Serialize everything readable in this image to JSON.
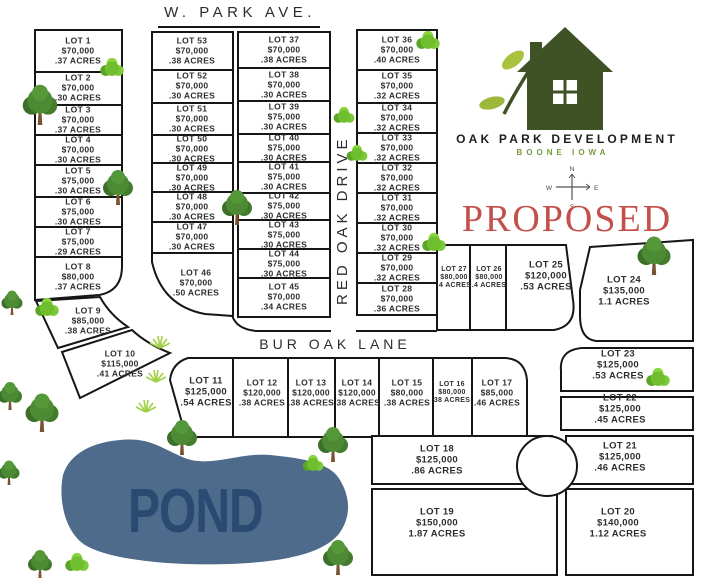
{
  "title": "Oak Park Development Plat Map",
  "streets": {
    "top": "W. PARK AVE.",
    "vertical": "RED OAK DRIVE",
    "horizontal": "BUR OAK LANE"
  },
  "branding": {
    "name": "OAK PARK DEVELOPMENT",
    "location": "BOONE   IOWA",
    "status": "PROPOSED"
  },
  "compass": {
    "n": "N",
    "e": "E",
    "s": "S",
    "w": "W"
  },
  "pond": {
    "label": "POND"
  },
  "colors": {
    "line": "#161616",
    "logo_green": "#3f5226",
    "leaf_green": "#a9c33f",
    "location_green": "#7a9a3d",
    "proposed_red": "#c3504b",
    "pond_fill": "#4e6b8c",
    "pond_text": "#2a4a72"
  },
  "lots": {
    "l1": {
      "name": "LOT 1",
      "price": "$70,000",
      "acres": ".37 ACRES"
    },
    "l2": {
      "name": "LOT 2",
      "price": "$70,000",
      "acres": ".30 ACRES"
    },
    "l3": {
      "name": "LOT 3",
      "price": "$70,000",
      "acres": ".37 ACRES"
    },
    "l4": {
      "name": "LOT 4",
      "price": "$70,000",
      "acres": ".30 ACRES"
    },
    "l5": {
      "name": "LOT 5",
      "price": "$75,000",
      "acres": ".30 ACRES"
    },
    "l6": {
      "name": "LOT 6",
      "price": "$75,000",
      "acres": ".30 ACRES"
    },
    "l7": {
      "name": "LOT 7",
      "price": "$75,000",
      "acres": ".29 ACRES"
    },
    "l8": {
      "name": "LOT 8",
      "price": "$80,000",
      "acres": ".37 ACRES"
    },
    "l9": {
      "name": "LOT 9",
      "price": "$85,000",
      "acres": ".38 ACRES"
    },
    "l10": {
      "name": "LOT 10",
      "price": "$115,000",
      "acres": ".41 ACRES"
    },
    "l11": {
      "name": "LOT 11",
      "price": "$125,000",
      "acres": ".54 ACRES"
    },
    "l12": {
      "name": "LOT 12",
      "price": "$120,000",
      "acres": ".38 ACRES"
    },
    "l13": {
      "name": "LOT 13",
      "price": "$120,000",
      "acres": ".38 ACRES"
    },
    "l14": {
      "name": "LOT 14",
      "price": "$120,000",
      "acres": ".38 ACRES"
    },
    "l15": {
      "name": "LOT 15",
      "price": "$80,000",
      "acres": ".38 ACRES"
    },
    "l16": {
      "name": "LOT 16",
      "price": "$80,000",
      "acres": "38 ACRES"
    },
    "l17": {
      "name": "LOT 17",
      "price": "$85,000",
      "acres": ".46 ACRES"
    },
    "l18": {
      "name": "LOT 18",
      "price": "$125,000",
      "acres": ".86 ACRES"
    },
    "l19": {
      "name": "LOT 19",
      "price": "$150,000",
      "acres": "1.87 ACRES"
    },
    "l20": {
      "name": "LOT 20",
      "price": "$140,000",
      "acres": "1.12 ACRES"
    },
    "l21": {
      "name": "LOT 21",
      "price": "$125,000",
      "acres": ".46 ACRES"
    },
    "l22": {
      "name": "LOT 22",
      "price": "$125,000",
      "acres": ".45 ACRES"
    },
    "l23": {
      "name": "LOT 23",
      "price": "$125,000",
      "acres": ".53 ACRES"
    },
    "l24": {
      "name": "LOT 24",
      "price": "$135,000",
      "acres": "1.1 ACRES"
    },
    "l25": {
      "name": "LOT 25",
      "price": "$120,000",
      "acres": ".53 ACRES"
    },
    "l26": {
      "name": "LOT 26",
      "price": "$80,000",
      "acres": ".4 ACRES"
    },
    "l27": {
      "name": "LOT 27",
      "price": "$80,000",
      "acres": ".4 ACRES"
    },
    "l28": {
      "name": "LOT 28",
      "price": "$70,000",
      "acres": ".36 ACRES"
    },
    "l29": {
      "name": "LOT 29",
      "price": "$70,000",
      "acres": ".32 ACRES"
    },
    "l30": {
      "name": "LOT 30",
      "price": "$70,000",
      "acres": ".32 ACRES"
    },
    "l31": {
      "name": "LOT 31",
      "price": "$70,000",
      "acres": ".32 ACRES"
    },
    "l32": {
      "name": "LOT 32",
      "price": "$70,000",
      "acres": ".32 ACRES"
    },
    "l33": {
      "name": "LOT 33",
      "price": "$70,000",
      "acres": ".32 ACRES"
    },
    "l34": {
      "name": "LOT 34",
      "price": "$70,000",
      "acres": ".32 ACRES"
    },
    "l35": {
      "name": "LOT 35",
      "price": "$70,000",
      "acres": ".32 ACRES"
    },
    "l36": {
      "name": "LOT 36",
      "price": "$70,000",
      "acres": ".40 ACRES"
    },
    "l37": {
      "name": "LOT 37",
      "price": "$70,000",
      "acres": ".38 ACRES"
    },
    "l38": {
      "name": "LOT 38",
      "price": "$70,000",
      "acres": ".30 ACRES"
    },
    "l39": {
      "name": "LOT 39",
      "price": "$75,000",
      "acres": ".30 ACRES"
    },
    "l40": {
      "name": "LOT 40",
      "price": "$75,000",
      "acres": ".30 ACRES"
    },
    "l41": {
      "name": "LOT 41",
      "price": "$75,000",
      "acres": ".30 ACRES"
    },
    "l42": {
      "name": "LOT 42",
      "price": "$75,000",
      "acres": ".30 ACRES"
    },
    "l43": {
      "name": "LOT 43",
      "price": "$75,000",
      "acres": ".30 ACRES"
    },
    "l44": {
      "name": "LOT 44",
      "price": "$75,000",
      "acres": ".30 ACRES"
    },
    "l45": {
      "name": "LOT 45",
      "price": "$70,000",
      "acres": ".34 ACRES"
    },
    "l46": {
      "name": "LOT 46",
      "price": "$70,000",
      "acres": ".50 ACRES"
    },
    "l47": {
      "name": "LOT 47",
      "price": "$70,000",
      "acres": ".30 ACRES"
    },
    "l48": {
      "name": "LOT 48",
      "price": "$70,000",
      "acres": ".30 ACRES"
    },
    "l49": {
      "name": "LOT 49",
      "price": "$70,000",
      "acres": ".30 ACRES"
    },
    "l50": {
      "name": "LOT 50",
      "price": "$70,000",
      "acres": ".30 ACRES"
    },
    "l51": {
      "name": "LOT 51",
      "price": "$70,000",
      "acres": ".30 ACRES"
    },
    "l52": {
      "name": "LOT 52",
      "price": "$70,000",
      "acres": ".30 ACRES"
    },
    "l53": {
      "name": "LOT 53",
      "price": "$70,000",
      "acres": ".38 ACRES"
    }
  }
}
